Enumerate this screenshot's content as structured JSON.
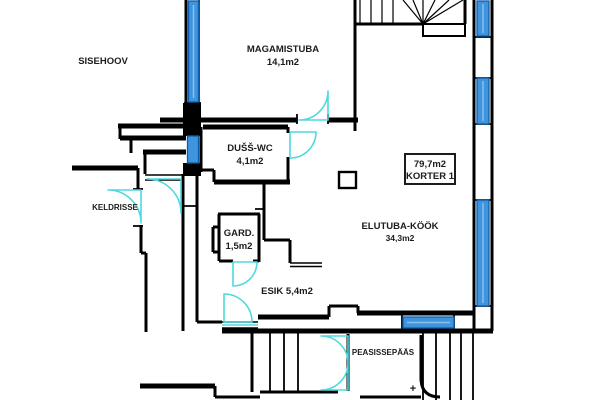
{
  "rooms": {
    "sisehoov": {
      "label": "SISEHOOV"
    },
    "magamistuba": {
      "label": "MAGAMISTUBA",
      "area": "14,1m2"
    },
    "duss_wc": {
      "label": "DUŠŠ-WC",
      "area": "4,1m2"
    },
    "keldrisse": {
      "label": "KELDRISSE"
    },
    "gard": {
      "label": "GARD.",
      "area": "1,5m2"
    },
    "esik": {
      "label": "ESIK 5,4m2"
    },
    "elutuba_kook": {
      "label": "ELUTUBA-KÖÖK",
      "area": "34,3m2"
    },
    "peasissepaas": {
      "label": "PEASISSEPÄÄS"
    }
  },
  "apartment": {
    "area": "79,7m2",
    "unit": "KORTER 1"
  },
  "symbols": {
    "plus": "+"
  },
  "colors": {
    "wall": "#000000",
    "window": "#3f95dd",
    "window_border": "#0f5ca8",
    "door": "#4ed9e0"
  }
}
